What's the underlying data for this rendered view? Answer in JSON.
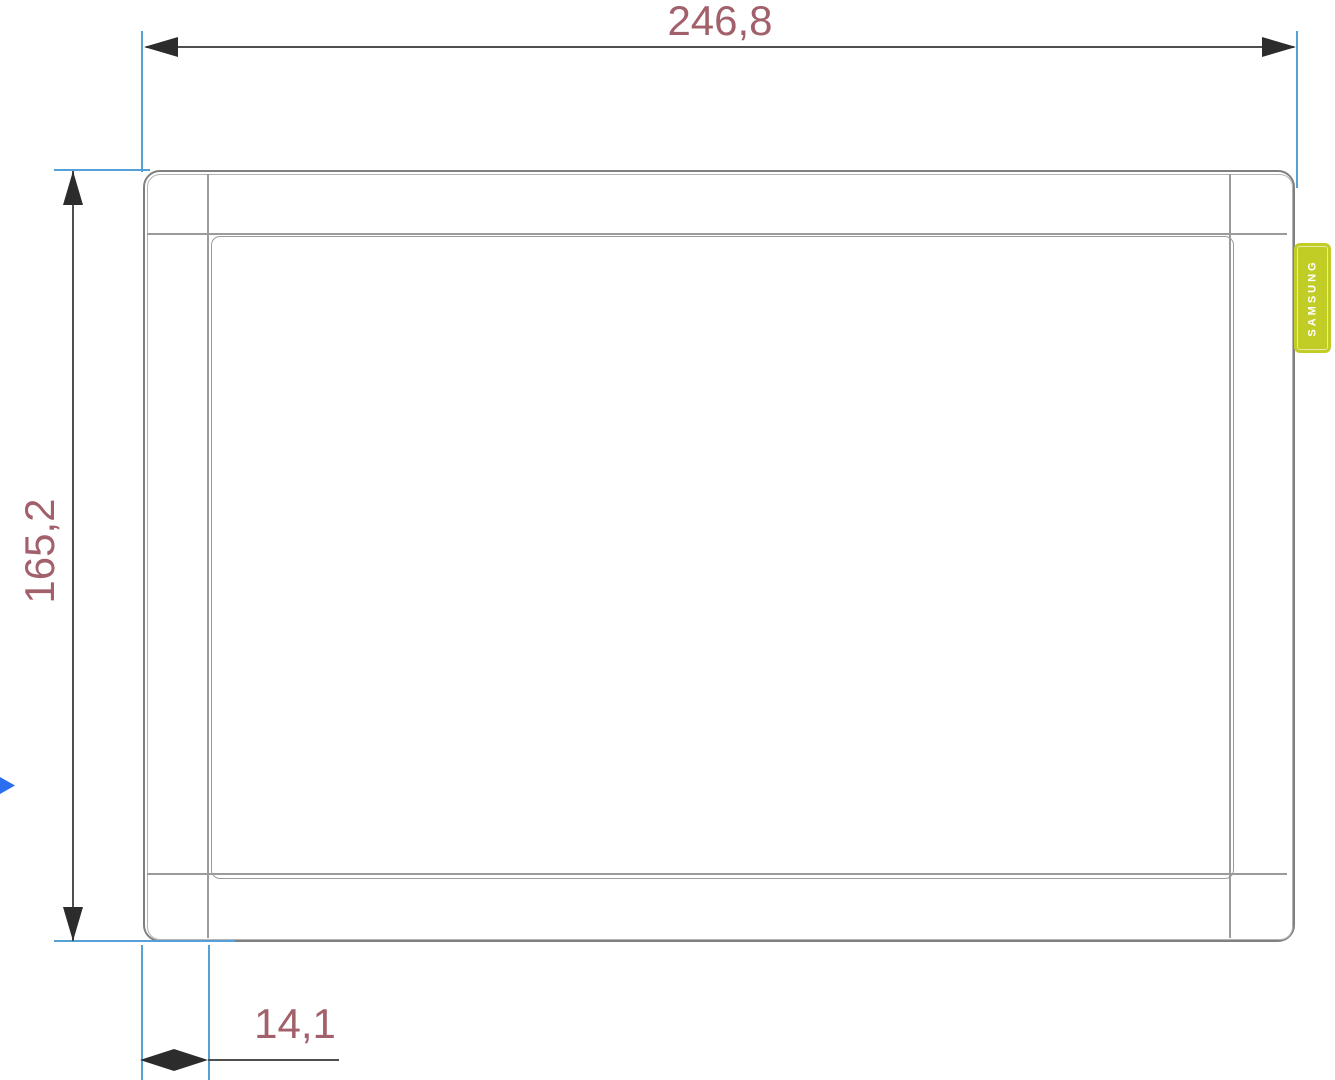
{
  "drawing": {
    "type": "technical-dimension-drawing",
    "view": "front",
    "dimensions": {
      "width": {
        "label": "246,8"
      },
      "height": {
        "label": "165,2"
      },
      "bezel": {
        "label": "14,1"
      }
    },
    "device": {
      "brand": "SAMSUNG"
    },
    "colors": {
      "dimension_text": "#a2606a",
      "dimension_line": "#4f4f4f",
      "arrowhead": "#2c2c2c",
      "extension_line": "#55a1d6",
      "device_outline": "#808080",
      "device_inner_line": "#9b9b9b",
      "badge_green": "#c1cd25",
      "badge_text": "#ffffff",
      "cursor_blue": "#2b6ef0",
      "background": "#ffffff"
    }
  }
}
